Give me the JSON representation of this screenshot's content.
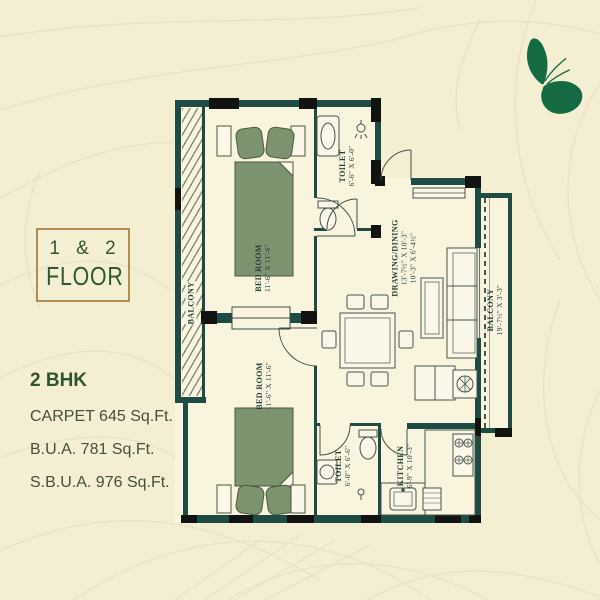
{
  "colors": {
    "background": "#f4eed2",
    "pattern_line": "#e7e2ca",
    "wall": "#1e4b43",
    "column_black": "#101310",
    "furniture_green": "#7d9370",
    "accent_gold": "#b28e4e",
    "text_green": "#2e5733",
    "text_dark": "#42503e",
    "butterfly_green": "#156a41"
  },
  "badge": {
    "line1": "1 & 2",
    "line2": "FLOOR"
  },
  "details": {
    "type": "2 BHK",
    "carpet": "CARPET 645 Sq.Ft.",
    "bua": "B.U.A. 781 Sq.Ft.",
    "sbua": "S.B.U.A. 976 Sq.Ft."
  },
  "plan": {
    "bedroom_top": {
      "name": "BED ROOM",
      "dim": "11'-6\" X 11'-6\""
    },
    "bedroom_bottom": {
      "name": "BED ROOM",
      "dim": "11'-6\" X 11'-6\""
    },
    "toilet_top": {
      "name": "TOILET",
      "dim": "6'-6\" X 6'-0\""
    },
    "toilet_bottom": {
      "name": "TOILET",
      "dim": "6'-0\" X 6'-6\""
    },
    "drawing_dining": {
      "name": "DRAWING/DINING",
      "dim1": "13'-7½\" X 10'-3\"",
      "dim2": "10'-3\" X 6'-4½\""
    },
    "kitchen": {
      "name": "KITCHEN",
      "dim": "6'-9\" X 10'-3\""
    },
    "balcony_left": {
      "name": "BALCONY"
    },
    "balcony_right": {
      "name": "BALCONY",
      "dim": "19'-7½\" X 3'-3\""
    }
  },
  "icons": {
    "butterfly": "butterfly-icon"
  }
}
